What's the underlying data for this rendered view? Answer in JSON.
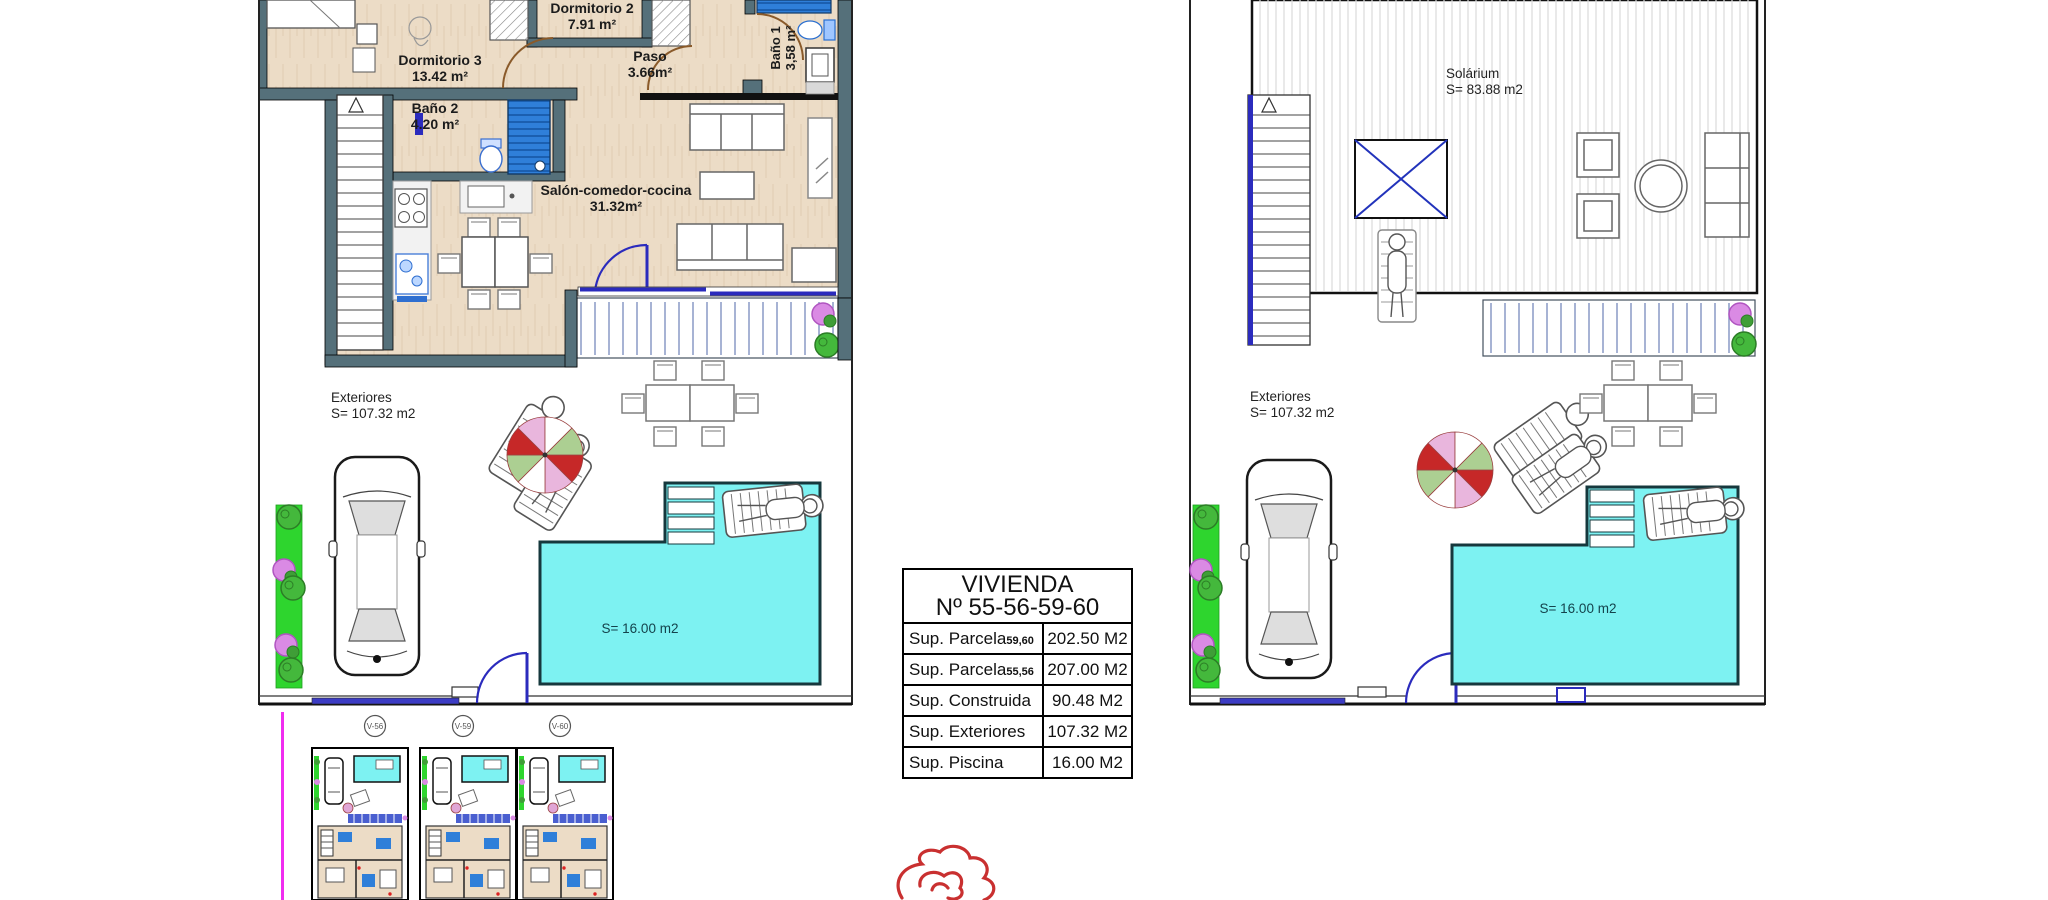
{
  "left_plan": {
    "rooms": [
      {
        "name": "Dormitorio 2",
        "area": "7.91 m²"
      },
      {
        "name": "Dormitorio 3",
        "area": "13.42 m²"
      },
      {
        "name": "Paso",
        "area": "3.66m²"
      },
      {
        "name": "Baño 2",
        "area": "4.20 m²"
      },
      {
        "name": "Baño 1",
        "area": "3,58 m²"
      },
      {
        "name": "Salón-comedor-cocina",
        "area": "31.32m²"
      }
    ],
    "exterior": {
      "title": "Exteriores",
      "area": "S= 107.32 m2"
    },
    "pool_area": "S= 16.00 m2"
  },
  "right_plan": {
    "solarium": {
      "title": "Solárium",
      "area": "S= 83.88 m2"
    },
    "exterior": {
      "title": "Exteriores",
      "area": "S= 107.32 m2"
    },
    "pool_area": "S= 16.00 m2"
  },
  "info_table": {
    "title_line1": "VIVIENDA",
    "title_line2": "Nº 55-56-59-60",
    "rows": [
      {
        "label": "Sup. Parcela",
        "sub": "59,60",
        "value": "202.50 M2"
      },
      {
        "label": "Sup. Parcela",
        "sub": "55,56",
        "value": "207.00 M2"
      },
      {
        "label": "Sup. Construida",
        "sub": "",
        "value": "90.48 M2"
      },
      {
        "label": "Sup. Exteriores",
        "sub": "",
        "value": "107.32 M2"
      },
      {
        "label": "Sup. Piscina",
        "sub": "",
        "value": "16.00 M2"
      }
    ]
  },
  "site_thumbnails": {
    "labels": [
      "V-56",
      "V-59",
      "V-60"
    ]
  },
  "colors": {
    "pool": "#7df2f2",
    "wall": "#55707a",
    "blue": "#2b2bbd",
    "green_strip": "#2ed52e",
    "magenta_line": "#f02df0",
    "rose_red": "#c93030",
    "floor": "#ecdcc6"
  }
}
